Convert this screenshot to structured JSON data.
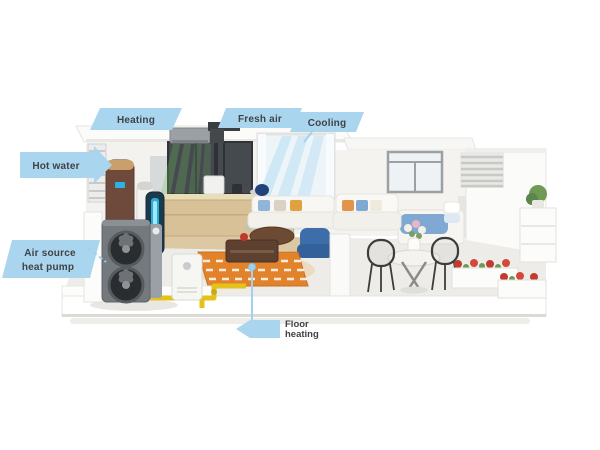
{
  "illustration": {
    "description": "3D cutaway house diagram of an air source heat pump whole-home system with callout labels",
    "callouts": {
      "heating": "Heating",
      "fresh_air": "Fresh air",
      "cooling": "Cooling",
      "hot_water": "Hot water",
      "heat_pump_line1": "Air source",
      "heat_pump_line2": "heat pump",
      "floor_heating_line1": "Floor",
      "floor_heating_line2": "heating"
    },
    "colors": {
      "callout_ribbon": "#a9d6ee",
      "callout_text": "#3f4245",
      "leader_blue": "#9fd2ee",
      "floor_heating_orange": "#e2832b",
      "pipe_yellow": "#e4c11b",
      "fresh_air_green": "#74c45c",
      "cool_air_blue": "#8fcdec",
      "heat_pump_gray": "#74797d",
      "water_tank_brown": "#6e4a3c",
      "bedding_blue": "#7fa8d2",
      "flower_red": "#c23b2e"
    }
  }
}
